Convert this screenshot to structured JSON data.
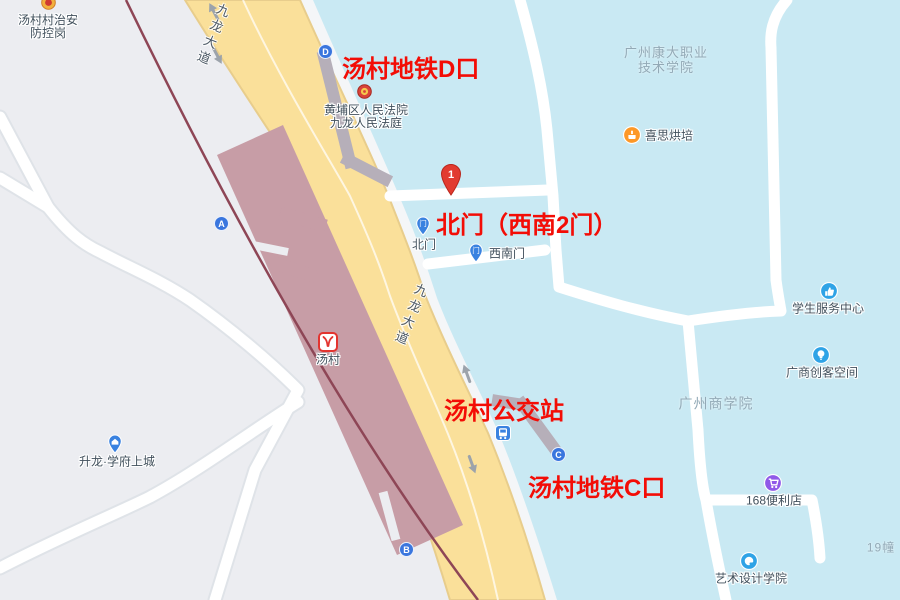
{
  "annotations": {
    "exit_d": "汤村地铁D口",
    "north_gate": "北门（西南2门）",
    "bus_station": "汤村公交站",
    "exit_c": "汤村地铁C口"
  },
  "pin": {
    "label": "1"
  },
  "station": {
    "name": "汤村"
  },
  "exits": {
    "a": "A",
    "b": "B",
    "c": "C",
    "d": "D"
  },
  "gates": {
    "north": "北门",
    "southwest": "西南门"
  },
  "road": {
    "name": "九龙大道"
  },
  "pois": {
    "police": {
      "line1": "汤村村治安",
      "line2": "防控岗"
    },
    "court": {
      "line1": "黄埔区人民法院",
      "line2": "九龙人民法庭"
    },
    "bakery": {
      "name": "喜思烘培"
    },
    "student_center": {
      "name": "学生服务中心"
    },
    "makerspace": {
      "name": "广商创客空间"
    },
    "store": {
      "name": "168便利店"
    },
    "art_school": {
      "name": "艺术设计学院"
    },
    "residence": {
      "name": "升龙·学府上城"
    }
  },
  "areas": {
    "kangda_line1": "广州康大职业",
    "kangda_line2": "技术学院",
    "business_college": "广州商学院",
    "building19": "19幢"
  },
  "colors": {
    "land": "#ECEDF1",
    "campus_area": "#C9E9F3",
    "main_road_fill": "#FAE09A",
    "main_road_edge": "#E8CD8C",
    "white_road": "#FFFFFF",
    "metro_line": "#8E4656",
    "platform": "#C79DA6",
    "walkway_gray": "#B6AFB9",
    "annotation_red": "#F30D06",
    "pin_red": "#E23B30",
    "marker_blue": "#3A76DE",
    "poi_blue": "#2FA3E6",
    "poi_purple": "#9059E8",
    "poi_orange": "#FD9827"
  }
}
